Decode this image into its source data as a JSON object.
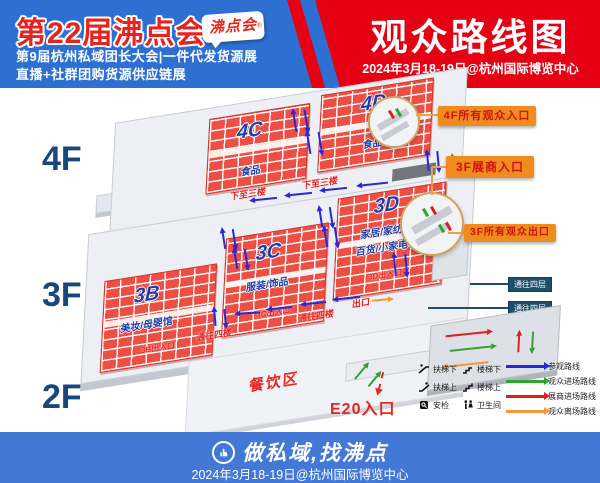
{
  "header": {
    "edition_title": "第22届沸点会",
    "logo": "沸点会",
    "reg_mark": "®",
    "subtitle_line1": "第9届杭州私域团长大会|一件代发货源展",
    "subtitle_line2": "直播+社群团购货源供应链展",
    "banner_title": "观众路线图",
    "banner_date": "2024年3月18-19日@杭州国际博览中心"
  },
  "floors": {
    "f4": {
      "label": "4F",
      "halls": [
        {
          "code": "4C",
          "category": "食品"
        },
        {
          "code": "4D",
          "category": "食品"
        }
      ],
      "down_notes": [
        "下至三楼",
        "下至三楼"
      ]
    },
    "f3": {
      "label": "3F",
      "halls": [
        {
          "code": "3B",
          "category": "美妆/母婴馆",
          "gate": "3B出入口"
        },
        {
          "code": "3C",
          "category": "服装/饰品",
          "gate": "3C出入口"
        },
        {
          "code": "3D",
          "category": "家居/家纺",
          "category2": "百货/小家电",
          "gate": "3D出入口"
        }
      ],
      "exit_label": "出口",
      "up_notes": [
        "通往四楼",
        "通往四楼"
      ]
    },
    "f2": {
      "label": "2F",
      "dining": "餐饮区",
      "entrance": "E20入口"
    }
  },
  "callouts": {
    "c1": "4F所有观众入口",
    "c2": "3F展商入口",
    "c3": "3F所有观众出口"
  },
  "side_labels": {
    "s1": "通往四层",
    "s2": "通往四层",
    "s3": "通往三层"
  },
  "legend": {
    "items": [
      {
        "icon": "escalator-down-icon",
        "label": "扶梯下"
      },
      {
        "icon": "stairs-down-icon",
        "label": "楼梯下"
      },
      {
        "icon": "escalator-up-icon",
        "label": "扶梯上"
      },
      {
        "icon": "stairs-up-icon",
        "label": "楼梯上"
      },
      {
        "icon": "security-icon",
        "label": "安检"
      },
      {
        "icon": "restroom-icon",
        "label": "卫生间"
      }
    ],
    "routes": [
      {
        "label": "参观路线",
        "color": "#2828d8"
      },
      {
        "label": "观众进场路线",
        "color": "#2fa32f"
      },
      {
        "label": "展商进场路线",
        "color": "#e01f1f"
      },
      {
        "label": "观众离场路线",
        "color": "#f2993c"
      }
    ]
  },
  "footer": {
    "slogan": "做私域,找沸点",
    "date": "2024年3月18-19日@杭州国际博览中心"
  },
  "colors": {
    "header_blue": "#2e6fd2",
    "banner_red": "#e60014",
    "footer_blue": "#4478d6",
    "hall_red": "#ee4f44",
    "callout_orange": "#f08c1d",
    "side_label_navy": "#1d4f68",
    "floor_label_blue": "#17477c"
  }
}
